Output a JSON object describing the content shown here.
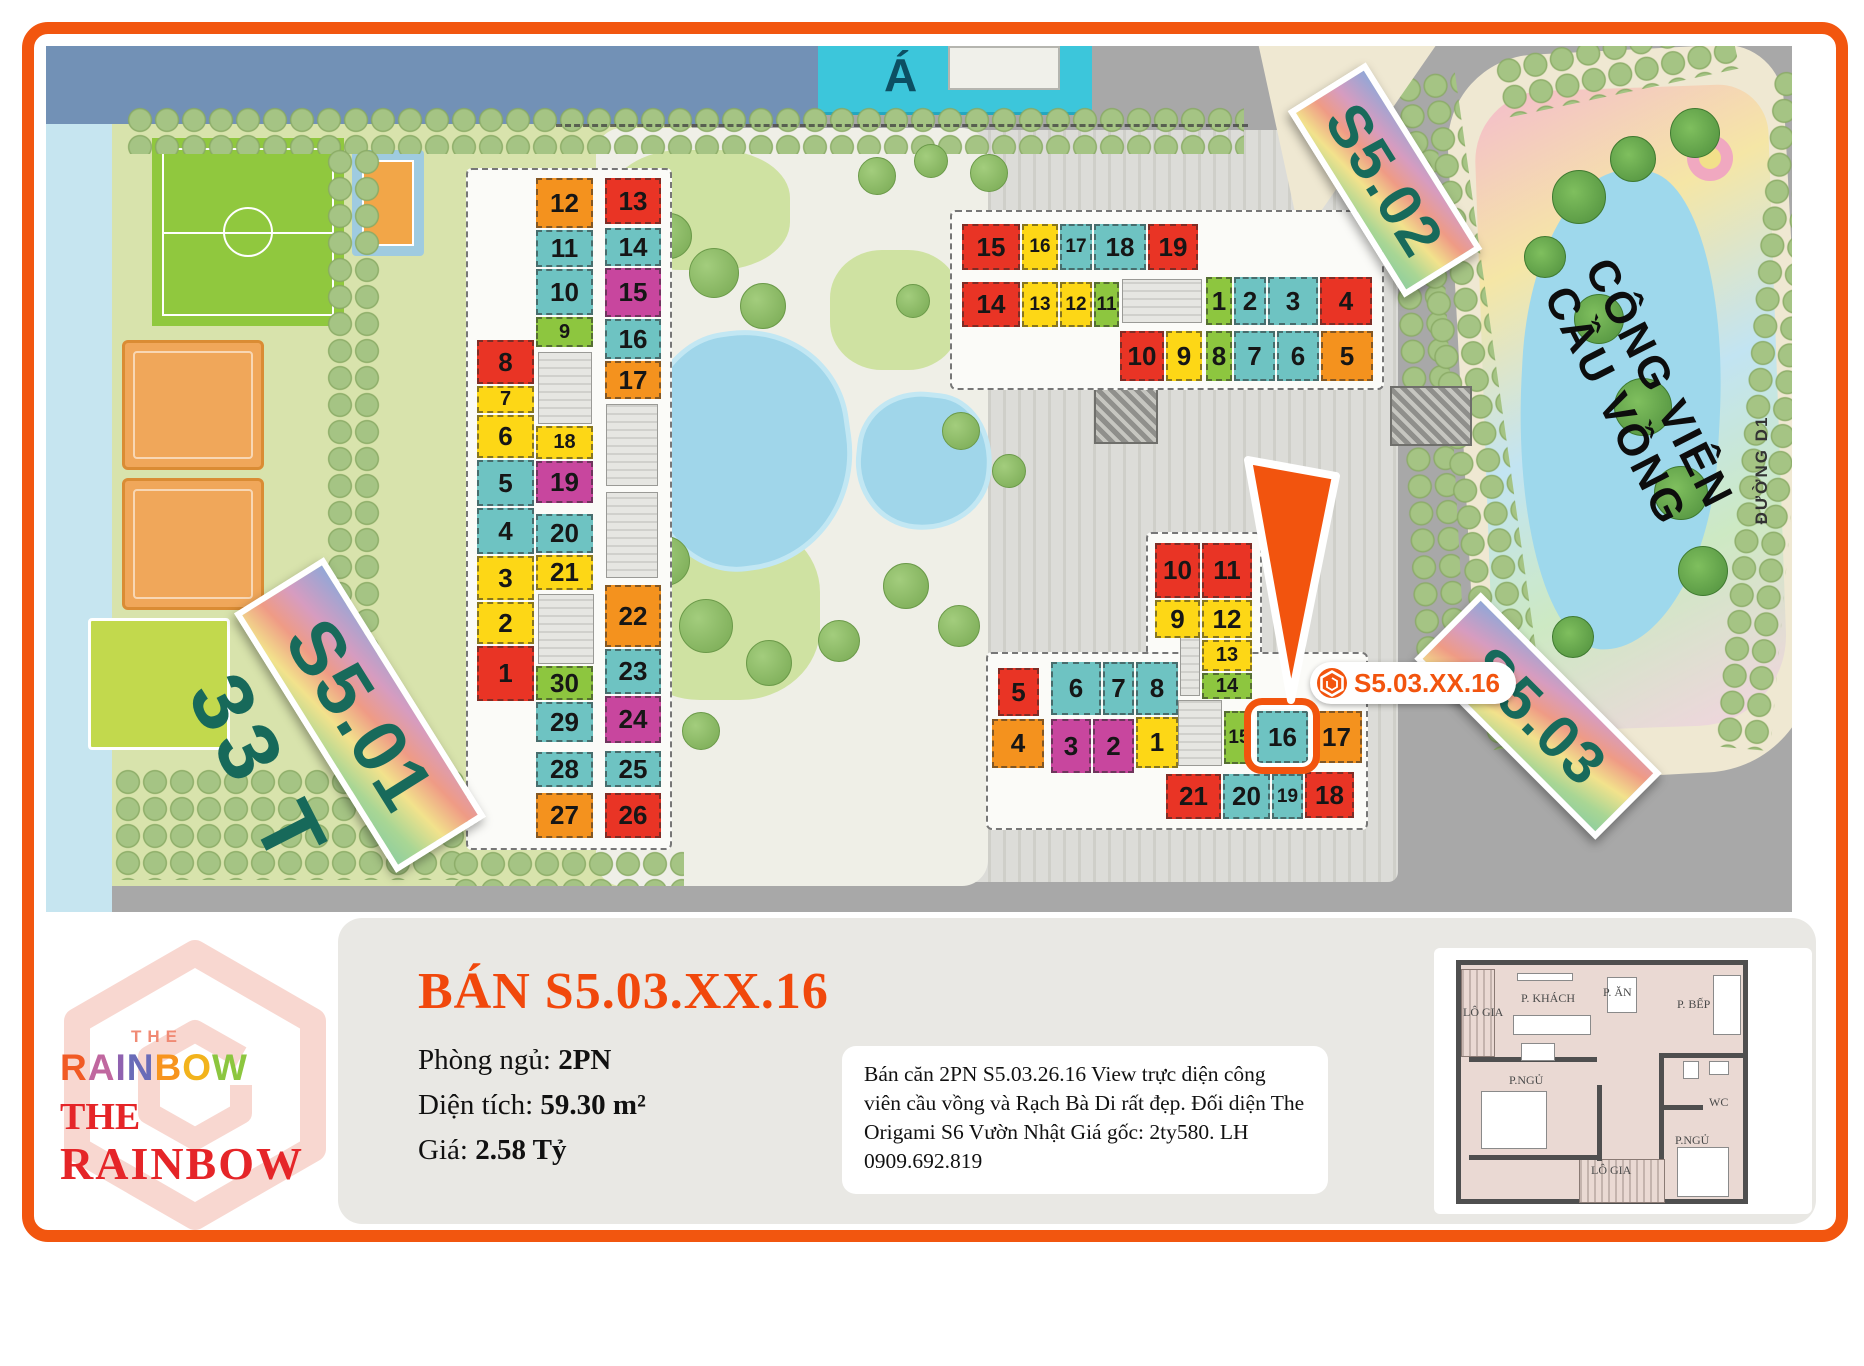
{
  "frame_color": "#f2560f",
  "map": {
    "bg": "#a8a8a8",
    "partial_building_label": "Á",
    "street_label": "ĐƯỜNG D1",
    "floors_label": "33 T",
    "park_name_line1": "CÔNG VIÊN",
    "park_name_line2": "CẦU VỒNG",
    "callout": {
      "text": "S5.03.XX.16",
      "color": "#f2540e"
    },
    "stickers": [
      {
        "text": "S5.01",
        "x": 360,
        "y": 715,
        "w": 306,
        "h": 106,
        "rot": 58,
        "fs": 76
      },
      {
        "text": "S5.02",
        "x": 1385,
        "y": 180,
        "w": 220,
        "h": 92,
        "rot": 58,
        "fs": 60
      },
      {
        "text": "S5.03",
        "x": 1538,
        "y": 716,
        "w": 256,
        "h": 94,
        "rot": 45,
        "fs": 60
      }
    ],
    "unit_colors": {
      "r": "#e93425",
      "o": "#f4921e",
      "y": "#fdd716",
      "t": "#6ec3c2",
      "g": "#8dc63f",
      "m": "#c8469e"
    },
    "units": [
      [
        "s501",
        "12",
        536,
        178,
        57,
        50,
        "o"
      ],
      [
        "s501",
        "11",
        536,
        230,
        57,
        37,
        "t"
      ],
      [
        "s501",
        "10",
        536,
        269,
        57,
        46,
        "t"
      ],
      [
        "s501",
        "9",
        536,
        317,
        57,
        30,
        "g"
      ],
      [
        "s501",
        "13",
        605,
        178,
        56,
        46,
        "r"
      ],
      [
        "s501",
        "14",
        605,
        228,
        56,
        38,
        "t"
      ],
      [
        "s501",
        "15",
        605,
        268,
        56,
        49,
        "m"
      ],
      [
        "s501",
        "16",
        605,
        319,
        56,
        40,
        "t"
      ],
      [
        "s501",
        "17",
        605,
        361,
        56,
        38,
        "o"
      ],
      [
        "s501",
        "8",
        477,
        340,
        57,
        44,
        "r"
      ],
      [
        "s501",
        "7",
        477,
        386,
        57,
        27,
        "y"
      ],
      [
        "s501",
        "6",
        477,
        415,
        57,
        43,
        "y"
      ],
      [
        "s501",
        "5",
        477,
        460,
        57,
        46,
        "t"
      ],
      [
        "s501",
        "4",
        477,
        508,
        57,
        46,
        "t"
      ],
      [
        "s501",
        "3",
        477,
        556,
        57,
        44,
        "y"
      ],
      [
        "s501",
        "2",
        477,
        602,
        57,
        42,
        "y"
      ],
      [
        "s501",
        "1",
        477,
        646,
        57,
        55,
        "r"
      ],
      [
        "s501",
        "18",
        536,
        426,
        57,
        33,
        "y"
      ],
      [
        "s501",
        "19",
        536,
        461,
        57,
        42,
        "m"
      ],
      [
        "s501",
        "20",
        536,
        514,
        57,
        39,
        "t"
      ],
      [
        "s501",
        "21",
        536,
        555,
        57,
        35,
        "y"
      ],
      [
        "s501",
        "22",
        605,
        585,
        56,
        62,
        "o"
      ],
      [
        "s501",
        "23",
        605,
        649,
        56,
        45,
        "t"
      ],
      [
        "s501",
        "24",
        605,
        696,
        56,
        47,
        "m"
      ],
      [
        "s501",
        "25",
        605,
        751,
        56,
        36,
        "t"
      ],
      [
        "s501",
        "26",
        605,
        793,
        56,
        45,
        "r"
      ],
      [
        "s501",
        "30",
        536,
        666,
        57,
        34,
        "g"
      ],
      [
        "s501",
        "29",
        536,
        702,
        57,
        40,
        "t"
      ],
      [
        "s501",
        "28",
        536,
        752,
        57,
        35,
        "t"
      ],
      [
        "s501",
        "27",
        536,
        793,
        57,
        45,
        "o"
      ],
      [
        "s502",
        "15",
        962,
        224,
        58,
        46,
        "r"
      ],
      [
        "s502",
        "16",
        1022,
        224,
        36,
        46,
        "y"
      ],
      [
        "s502",
        "17",
        1060,
        224,
        32,
        46,
        "t"
      ],
      [
        "s502",
        "18",
        1094,
        224,
        52,
        46,
        "t"
      ],
      [
        "s502",
        "19",
        1148,
        224,
        50,
        46,
        "r"
      ],
      [
        "s502",
        "14",
        962,
        282,
        58,
        45,
        "r"
      ],
      [
        "s502",
        "13",
        1022,
        282,
        36,
        45,
        "y"
      ],
      [
        "s502",
        "12",
        1060,
        282,
        32,
        45,
        "y"
      ],
      [
        "s502",
        "11",
        1094,
        282,
        25,
        45,
        "g"
      ],
      [
        "s502",
        "1",
        1206,
        277,
        26,
        48,
        "g"
      ],
      [
        "s502",
        "2",
        1234,
        277,
        32,
        48,
        "t"
      ],
      [
        "s502",
        "3",
        1268,
        277,
        50,
        48,
        "t"
      ],
      [
        "s502",
        "4",
        1320,
        277,
        52,
        48,
        "r"
      ],
      [
        "s502",
        "10",
        1120,
        331,
        44,
        50,
        "r"
      ],
      [
        "s502",
        "9",
        1166,
        331,
        36,
        50,
        "y"
      ],
      [
        "s502",
        "8",
        1206,
        331,
        26,
        50,
        "g"
      ],
      [
        "s502",
        "7",
        1234,
        331,
        41,
        50,
        "t"
      ],
      [
        "s502",
        "6",
        1277,
        331,
        42,
        50,
        "t"
      ],
      [
        "s502",
        "5",
        1321,
        331,
        52,
        50,
        "o"
      ],
      [
        "s503",
        "10",
        1155,
        543,
        45,
        55,
        "r"
      ],
      [
        "s503",
        "11",
        1202,
        543,
        50,
        55,
        "r"
      ],
      [
        "s503",
        "9",
        1155,
        600,
        45,
        38,
        "y"
      ],
      [
        "s503",
        "12",
        1202,
        600,
        50,
        38,
        "y"
      ],
      [
        "s503",
        "13",
        1202,
        640,
        50,
        31,
        "y"
      ],
      [
        "s503",
        "14",
        1202,
        673,
        50,
        26,
        "g"
      ],
      [
        "s503",
        "5",
        998,
        668,
        41,
        48,
        "r"
      ],
      [
        "s503",
        "6",
        1051,
        662,
        50,
        53,
        "t"
      ],
      [
        "s503",
        "7",
        1103,
        662,
        31,
        53,
        "t"
      ],
      [
        "s503",
        "8",
        1136,
        662,
        42,
        53,
        "t"
      ],
      [
        "s503",
        "4",
        992,
        719,
        52,
        49,
        "o"
      ],
      [
        "s503",
        "3",
        1051,
        719,
        40,
        54,
        "m"
      ],
      [
        "s503",
        "2",
        1093,
        719,
        41,
        54,
        "m"
      ],
      [
        "s503",
        "1",
        1136,
        717,
        42,
        51,
        "y"
      ],
      [
        "s503",
        "15",
        1224,
        711,
        30,
        53,
        "g"
      ],
      [
        "s503",
        "16",
        1257,
        711,
        51,
        52,
        "t"
      ],
      [
        "s503",
        "17",
        1311,
        711,
        51,
        52,
        "o"
      ],
      [
        "s503",
        "21",
        1166,
        774,
        55,
        45,
        "r"
      ],
      [
        "s503",
        "20",
        1223,
        774,
        47,
        45,
        "t"
      ],
      [
        "s503",
        "19",
        1272,
        774,
        31,
        45,
        "t"
      ],
      [
        "s503",
        "18",
        1305,
        772,
        49,
        46,
        "r"
      ]
    ],
    "cores": [
      [
        538,
        352,
        54,
        72
      ],
      [
        538,
        594,
        56,
        70
      ],
      [
        606,
        404,
        52,
        82
      ],
      [
        606,
        492,
        52,
        86
      ],
      [
        1122,
        279,
        80,
        44
      ],
      [
        1180,
        604,
        20,
        92
      ],
      [
        1178,
        700,
        44,
        66
      ]
    ],
    "hatch_blocks": [
      [
        1094,
        388,
        64,
        56
      ],
      [
        1390,
        386,
        82,
        60
      ]
    ],
    "green_patches": [
      [
        610,
        150,
        180,
        120
      ],
      [
        620,
        520,
        200,
        180
      ],
      [
        830,
        250,
        130,
        120
      ]
    ],
    "tree_strips": [
      [
        126,
        106,
        1118,
        48,
        0
      ],
      [
        326,
        148,
        54,
        624,
        0
      ],
      [
        114,
        768,
        352,
        112,
        0
      ],
      [
        452,
        850,
        232,
        36,
        0
      ],
      [
        1402,
        148,
        50,
        530,
        -3
      ],
      [
        1440,
        70,
        62,
        680,
        -8
      ],
      [
        1744,
        70,
        56,
        680,
        5
      ],
      [
        1496,
        34,
        240,
        60,
        -12
      ]
    ],
    "trees": [
      [
        620,
        190,
        20
      ],
      [
        668,
        235,
        22
      ],
      [
        713,
        272,
        24
      ],
      [
        762,
        305,
        22
      ],
      [
        648,
        340,
        18
      ],
      [
        628,
        470,
        20
      ],
      [
        664,
        560,
        24
      ],
      [
        705,
        625,
        26
      ],
      [
        768,
        662,
        22
      ],
      [
        838,
        640,
        20
      ],
      [
        905,
        585,
        22
      ],
      [
        958,
        625,
        20
      ],
      [
        876,
        175,
        18
      ],
      [
        930,
        160,
        16
      ],
      [
        988,
        172,
        18
      ],
      [
        912,
        300,
        16
      ],
      [
        960,
        430,
        18
      ],
      [
        1008,
        470,
        16
      ],
      [
        648,
        705,
        20
      ],
      [
        700,
        730,
        18
      ]
    ],
    "palms": [
      [
        1578,
        196,
        26
      ],
      [
        1632,
        158,
        22
      ],
      [
        1694,
        132,
        24
      ],
      [
        1598,
        318,
        24
      ],
      [
        1642,
        406,
        28
      ],
      [
        1680,
        492,
        26
      ],
      [
        1702,
        570,
        24
      ],
      [
        1572,
        636,
        20
      ],
      [
        1544,
        256,
        20
      ]
    ]
  },
  "logo": {
    "the_top": "THE",
    "rainbow_letters": [
      {
        "ch": "R",
        "color": "#f15a24"
      },
      {
        "ch": "A",
        "color": "#c0679f"
      },
      {
        "ch": "I",
        "color": "#8f62b0"
      },
      {
        "ch": "N",
        "color": "#6a6cb8"
      },
      {
        "ch": "B",
        "color": "#f7941e"
      },
      {
        "ch": "O",
        "color": "#f2b31c"
      },
      {
        "ch": "W",
        "color": "#8cc63f"
      }
    ],
    "the_red": "THE",
    "rainbow_red": "RAINBOW"
  },
  "panel": {
    "title": "BÁN S5.03.XX.16",
    "details": [
      {
        "label": "Phòng ngủ: ",
        "value": "2PN"
      },
      {
        "label": "Diện tích: ",
        "value": "59.30 m²"
      },
      {
        "label": "Giá: ",
        "value": "2.58 Tỷ"
      }
    ],
    "description": "Bán căn 2PN S5.03.26.16 View trực diện công viên cầu vồng và Rạch Bà Di rất đẹp. Đối diện The Origami S6 Vườn Nhật Giá gốc: 2ty580. LH 0909.692.819"
  },
  "floorplan": {
    "labels": [
      {
        "t": "LÔ GIA",
        "x": 2,
        "y": 40
      },
      {
        "t": "P. KHÁCH",
        "x": 60,
        "y": 26
      },
      {
        "t": "P. ĂN",
        "x": 142,
        "y": 20
      },
      {
        "t": "P. BẾP",
        "x": 216,
        "y": 32
      },
      {
        "t": "P.NGỦ",
        "x": 48,
        "y": 108
      },
      {
        "t": "WC",
        "x": 248,
        "y": 130
      },
      {
        "t": "P.NGỦ",
        "x": 214,
        "y": 168
      },
      {
        "t": "LÔ GIA",
        "x": 130,
        "y": 198
      }
    ],
    "balconies": [
      [
        0,
        4,
        34,
        88
      ],
      [
        118,
        194,
        86,
        44
      ]
    ],
    "walls": [
      [
        8,
        92,
        128,
        5
      ],
      [
        198,
        88,
        86,
        5
      ],
      [
        198,
        88,
        5,
        106
      ],
      [
        198,
        140,
        44,
        5
      ],
      [
        136,
        120,
        5,
        76
      ],
      [
        8,
        190,
        130,
        5
      ]
    ],
    "furniture": [
      [
        52,
        50,
        78,
        20
      ],
      [
        60,
        78,
        34,
        18
      ],
      [
        56,
        8,
        56,
        8
      ],
      [
        146,
        12,
        30,
        36
      ],
      [
        252,
        10,
        28,
        60
      ],
      [
        20,
        126,
        66,
        58
      ],
      [
        216,
        182,
        52,
        50
      ],
      [
        222,
        96,
        16,
        18
      ],
      [
        248,
        96,
        20,
        14
      ]
    ]
  }
}
